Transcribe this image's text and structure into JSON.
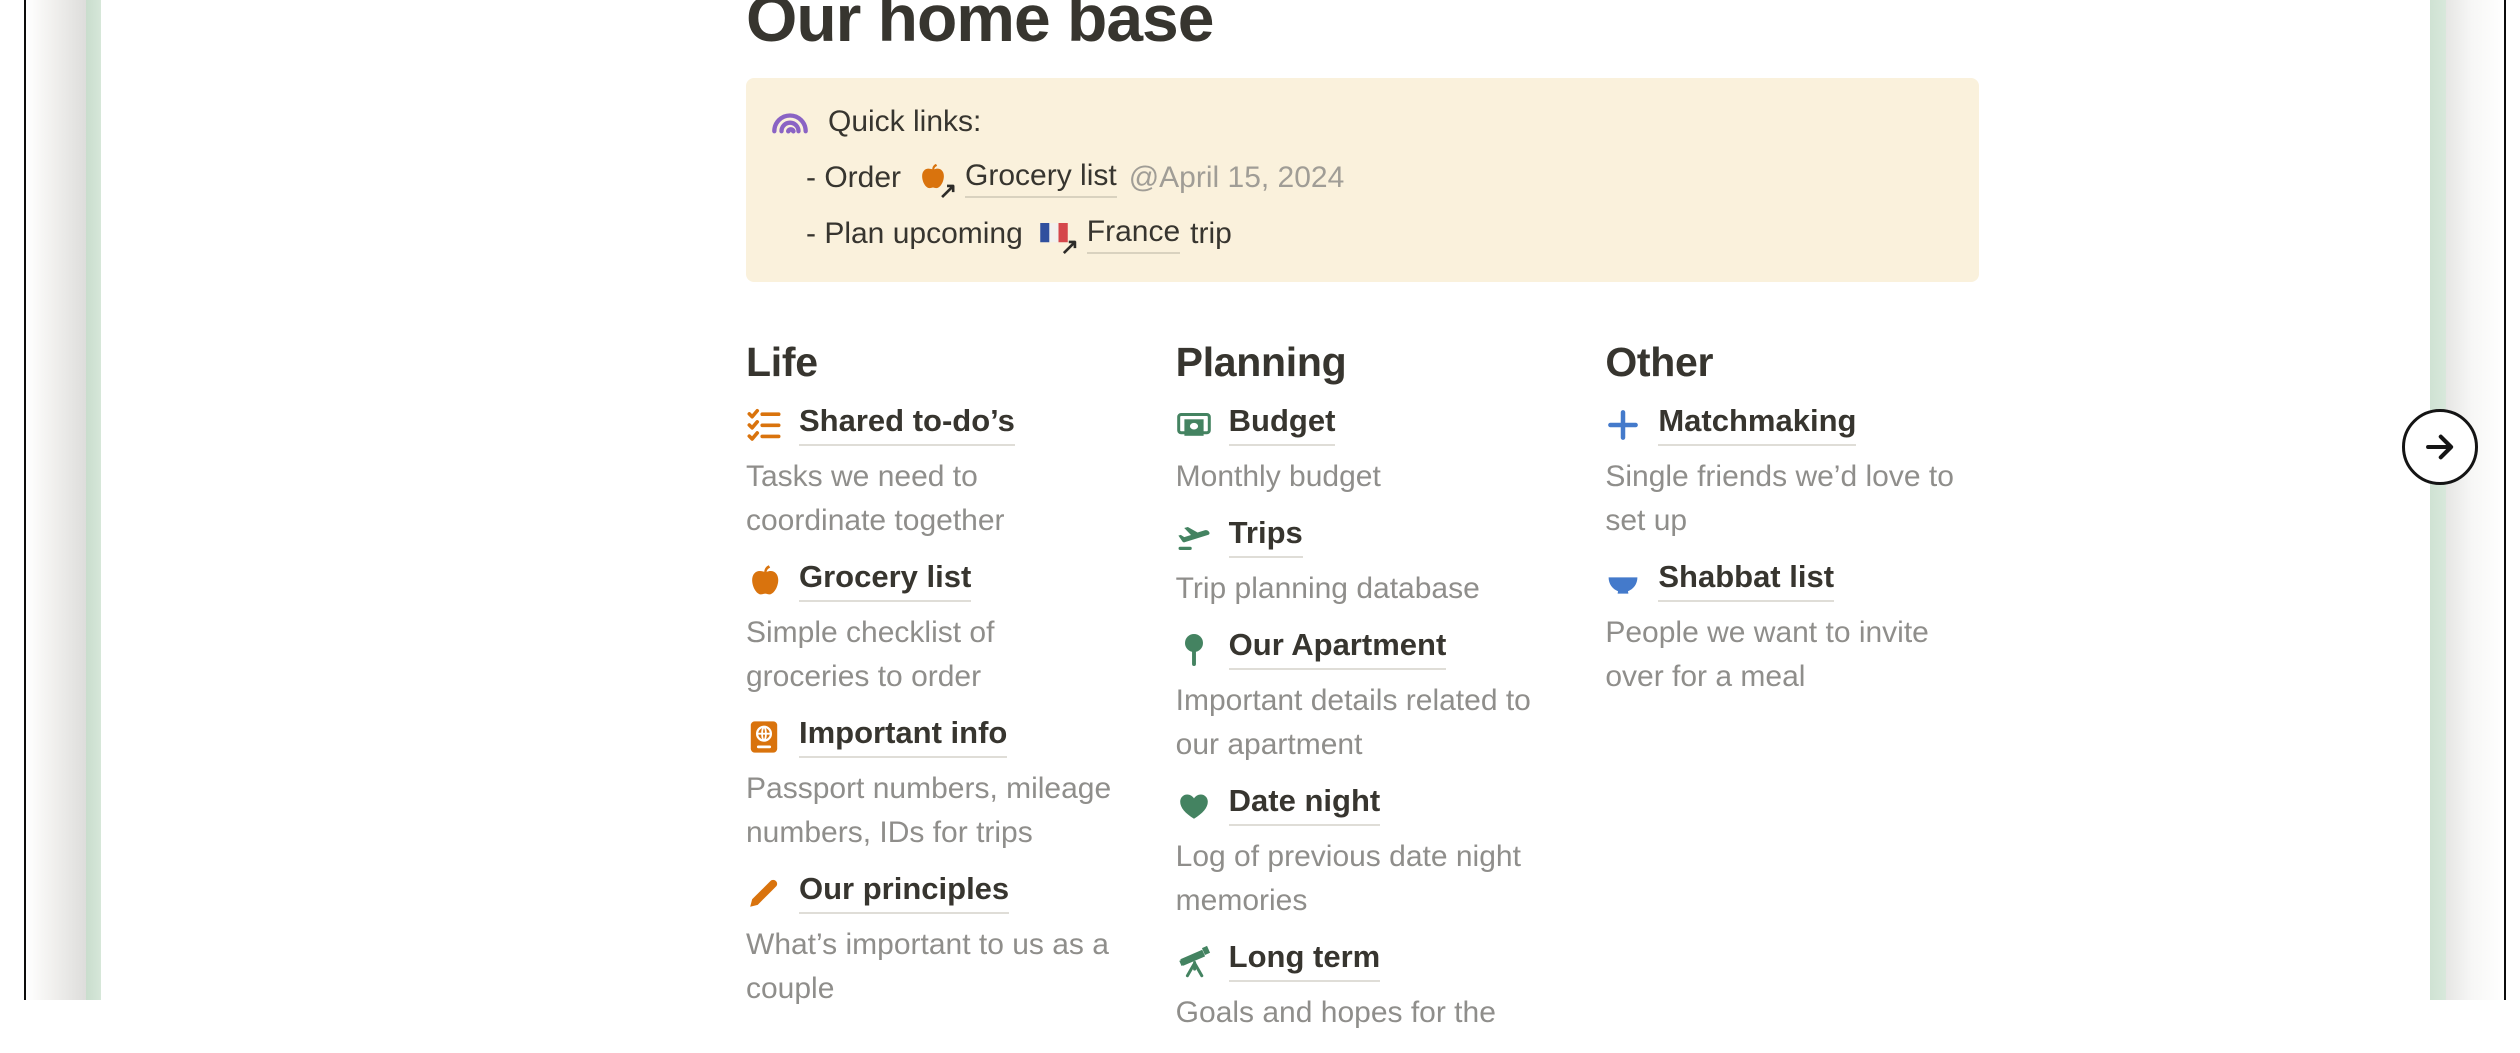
{
  "page_title": "Our home base",
  "callout": {
    "icon": "rainbow",
    "heading": "Quick links:",
    "line1": {
      "prefix": "- Order",
      "link_icon": "apple",
      "link": "Grocery list",
      "mention": "@April 15, 2024"
    },
    "line2": {
      "prefix": "- Plan upcoming",
      "link_icon": "france-flag",
      "link": "France",
      "suffix": "trip"
    }
  },
  "sections": [
    {
      "heading": "Life",
      "accent_color": "#D9730D",
      "items": [
        {
          "icon": "checklist",
          "title": "Shared to-do’s",
          "description": "Tasks we need to coordinate together"
        },
        {
          "icon": "apple",
          "title": "Grocery list",
          "description": "Simple checklist of groceries to order"
        },
        {
          "icon": "passport",
          "title": "Important info",
          "description": "Passport numbers, mileage numbers, IDs for trips"
        },
        {
          "icon": "pencil",
          "title": "Our principles",
          "description": "What’s important to us as a couple"
        }
      ]
    },
    {
      "heading": "Planning",
      "accent_color": "#448361",
      "items": [
        {
          "icon": "banknote",
          "title": "Budget",
          "description": "Monthly budget"
        },
        {
          "icon": "airplane-takeoff",
          "title": "Trips",
          "description": "Trip planning database"
        },
        {
          "icon": "round-pushpin",
          "title": "Our Apartment",
          "description": "Important details related to our apartment"
        },
        {
          "icon": "heart",
          "title": "Date night",
          "description": "Log of previous date night memories"
        },
        {
          "icon": "telescope",
          "title": "Long term",
          "description": "Goals and hopes for the"
        }
      ]
    },
    {
      "heading": "Other",
      "accent_color": "#447ACB",
      "items": [
        {
          "icon": "plus",
          "title": "Matchmaking",
          "description": "Single friends we’d love to set up"
        },
        {
          "icon": "bowl",
          "title": "Shabbat list",
          "description": "People we want to invite over for a meal"
        }
      ]
    }
  ],
  "next_button": {
    "icon": "arrow-right"
  },
  "colors": {
    "accent_orange": "#D9730D",
    "accent_green": "#448361",
    "accent_blue": "#447ACB",
    "accent_purple": "#8A63C4",
    "callout_bg": "#FAF1DC",
    "edge_stripe_green": "#CFE2D3",
    "text_primary": "#37352F",
    "text_secondary": "#8F8E8B"
  }
}
